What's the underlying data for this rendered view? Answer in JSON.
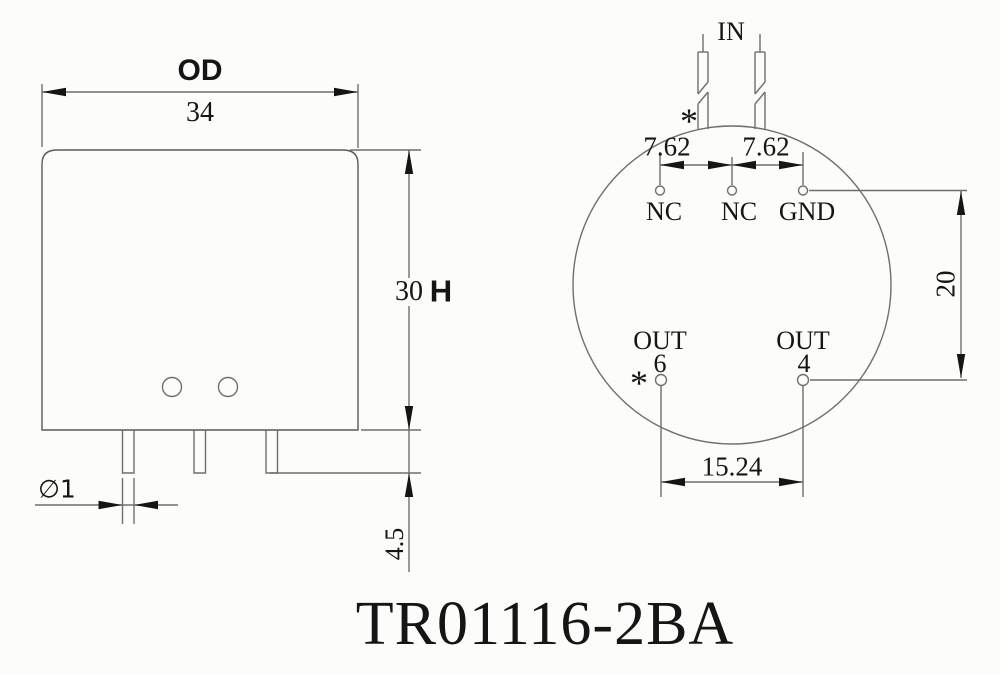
{
  "title": "TR01116-2BA",
  "colors": {
    "line": "#6f6f6f",
    "outline": "#5a5a5a",
    "ink": "#151515",
    "background": "#fcfcfb"
  },
  "front_view": {
    "width_label": "OD",
    "width_value": "34",
    "height_value": "30",
    "height_label": "H",
    "pin_diameter": "∅1",
    "pin_length": "4.5"
  },
  "bottom_view": {
    "input_label": "IN",
    "input_polarity_marker": "*",
    "pitch_left": "7.62",
    "pitch_right": "7.62",
    "row_spacing": "20",
    "out_pitch": "15.24",
    "pins": {
      "nc1": "NC",
      "nc2": "NC",
      "gnd": "GND",
      "out6": {
        "label": "OUT",
        "number": "6",
        "polarity_marker": "*"
      },
      "out4": {
        "label": "OUT",
        "number": "4"
      }
    }
  }
}
